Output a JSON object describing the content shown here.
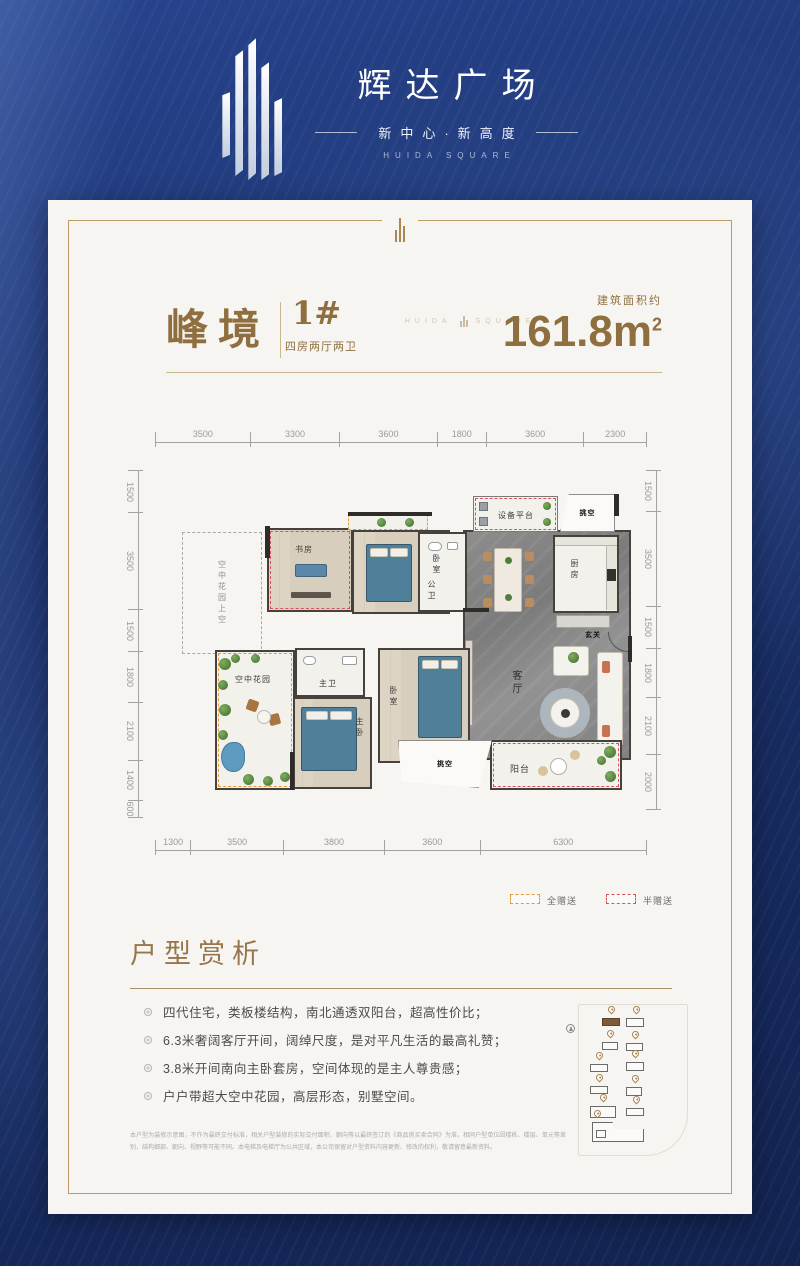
{
  "header": {
    "brand": "辉达广场",
    "tagline": "新中心·新高度",
    "tagline_en": "HUIDA SQUARE"
  },
  "plan": {
    "name": "峰境",
    "unit": "1#",
    "layout_type": "四房两厅两卫",
    "watermark_left": "HUIDA",
    "watermark_right": "SQUARE",
    "area_label": "建筑面积约",
    "area_value": "161.8m",
    "area_sup": "2"
  },
  "dimensions": {
    "top": [
      "3500",
      "3300",
      "3600",
      "1800",
      "3600",
      "2300"
    ],
    "bottom": [
      "1300",
      "3500",
      "3800",
      "3600",
      "6300"
    ],
    "left": [
      "1500",
      "3500",
      "1500",
      "1800",
      "2100",
      "1400",
      "600"
    ],
    "right": [
      "1500",
      "3500",
      "1500",
      "1800",
      "2100",
      "2000"
    ]
  },
  "rooms": {
    "sky_void": "空中花园上空",
    "study": "书房",
    "bedroom_top": "卧室",
    "public_bath": "公卫",
    "equipment": "设备平台",
    "void_top": "挑空",
    "kitchen": "厨房",
    "foyer": "玄关",
    "living": "客厅",
    "master_bath": "主卫",
    "master_bed": "主卧",
    "bedroom_mid": "卧室",
    "sky_garden": "空中花园",
    "balcony": "阳台",
    "void_bottom": "挑空"
  },
  "legend": {
    "full": "全赠送",
    "half": "半赠送"
  },
  "analysis": {
    "title": "户型赏析",
    "bullets": [
      "四代住宅，类板楼结构，南北通透双阳台，超高性价比；",
      "6.3米奢阔客厅开间，阔绰尺度，是对平凡生活的最高礼赞；",
      "3.8米开间南向主卧套房，空间体现的是主人尊贵感；",
      "户户带超大空中花园，高层形态，别墅空间。"
    ]
  },
  "disclaimer": "本户型为装修示意图，不作为最终交付标准，相关户型装修的实际交付面积、朝向等以最终签订的《商品房买卖合同》为准，相同户型单位因楼栋、楼层、单元等差别，结构细部、朝向、视野等可能不同。本电梯及电梯厅为公共区域，本公司保留对户型资料内容更新、修改的权利，敬请留意最新资料。",
  "colors": {
    "accent_gold": "#96764a",
    "legend_full": "#e39a3b",
    "legend_half": "#d9535f",
    "background_blue": "#1b3570"
  }
}
